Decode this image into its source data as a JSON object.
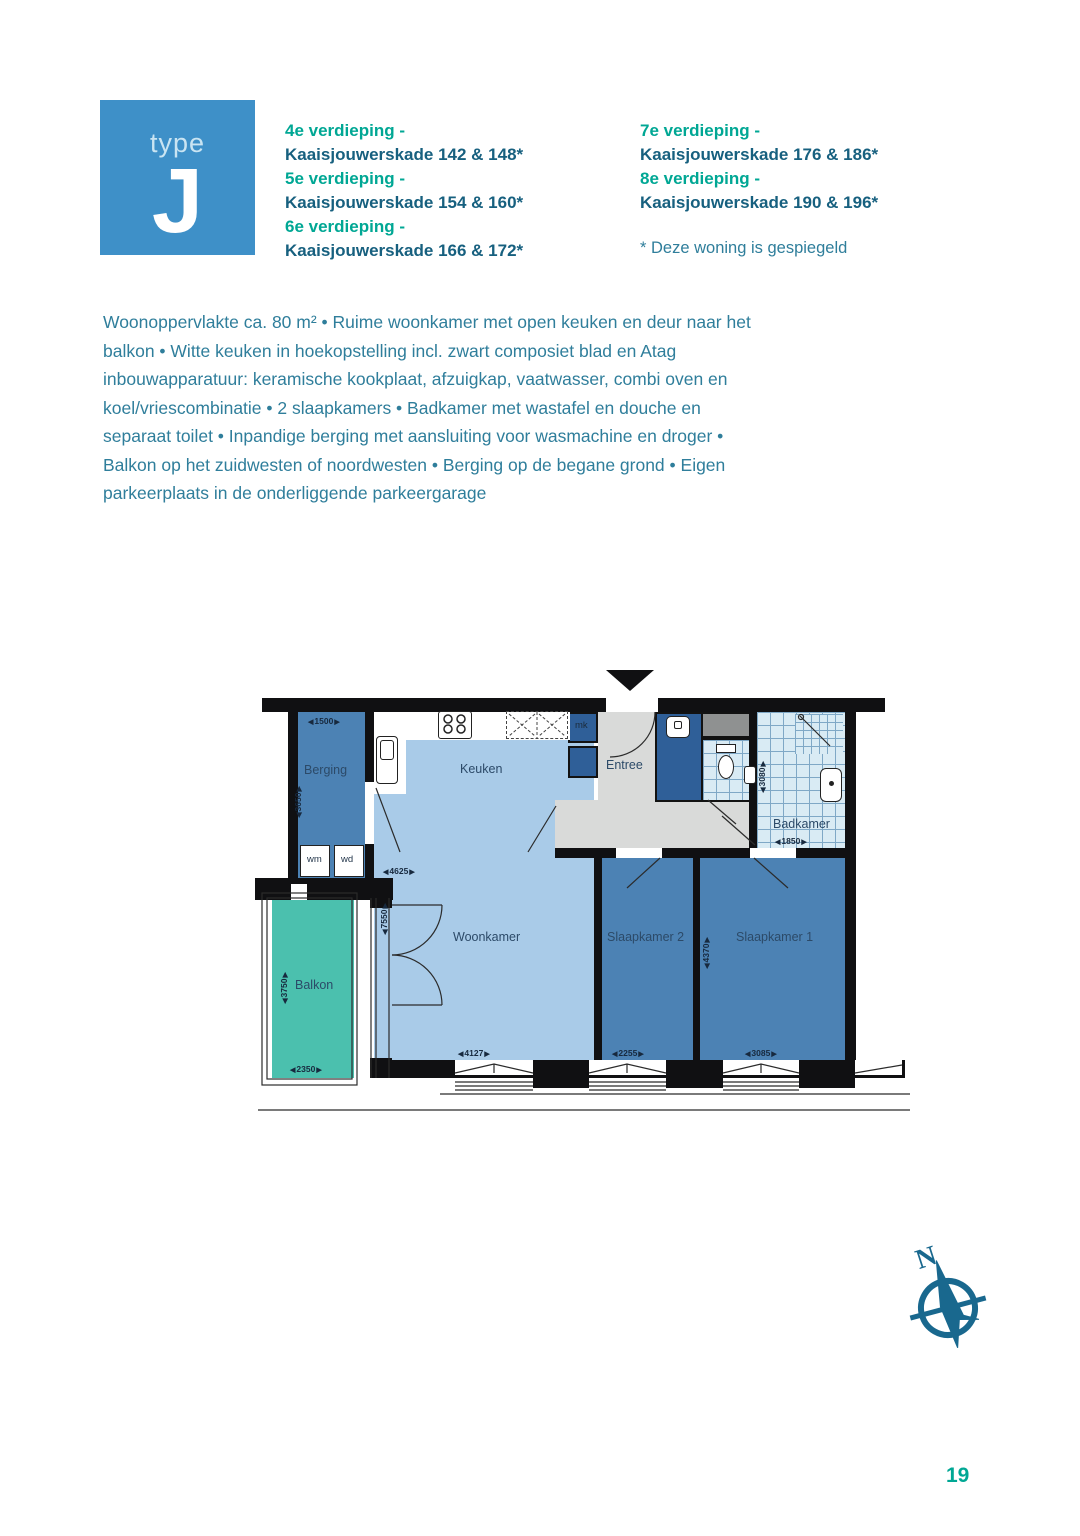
{
  "badge": {
    "word": "type",
    "letter": "J"
  },
  "floors": {
    "col1": [
      {
        "floor": "4e verdieping -",
        "address": "Kaaisjouwerskade 142 & 148*"
      },
      {
        "floor": "5e verdieping -",
        "address": "Kaaisjouwerskade 154 & 160*"
      },
      {
        "floor": "6e verdieping -",
        "address": "Kaaisjouwerskade 166 & 172*"
      }
    ],
    "col2": [
      {
        "floor": "7e verdieping -",
        "address": "Kaaisjouwerskade 176 & 186*"
      },
      {
        "floor": "8e verdieping -",
        "address": "Kaaisjouwerskade 190 & 196*"
      }
    ],
    "mirror_note": "* Deze woning is gespiegeld"
  },
  "description": "Woonoppervlakte ca. 80 m² • Ruime woonkamer met open keuken en deur naar het balkon • Witte keuken in hoekopstelling incl. zwart composiet blad en Atag inbouwapparatuur: keramische kookplaat, afzuigkap, vaatwasser, combi oven en koel/vriescombinatie • 2 slaapkamers • Badkamer met wastafel en douche en separaat toilet • Inpandige berging met aansluiting voor wasmachine en droger • Balkon op het zuidwesten of noordwesten • Berging op de begane grond • Eigen parkeerplaats in de onderliggende parkeergarage",
  "plan": {
    "rooms": {
      "berging": "Berging",
      "keuken": "Keuken",
      "entree": "Entree",
      "badkamer": "Badkamer",
      "woonkamer": "Woonkamer",
      "slaapkamer2": "Slaapkamer 2",
      "slaapkamer1": "Slaapkamer 1",
      "balkon": "Balkon",
      "mk": "mk",
      "wm": "wm",
      "wd": "wd"
    },
    "dimensions": {
      "berging_width": "1500",
      "berging_depth": "3650",
      "keuken_width": "4625",
      "woonkamer_depth": "7550",
      "woonkamer_width": "4127",
      "slaapkamer2_width": "2255",
      "slaapkamer1_width": "3085",
      "slaapkamer1_depth": "4370",
      "badkamer_depth": "3080",
      "badkamer_width": "1850",
      "balkon_depth": "3750",
      "balkon_width": "2350"
    }
  },
  "compass": {
    "north_label": "N"
  },
  "page_number": "19",
  "colors": {
    "accent_teal": "#00A794",
    "heading_blue": "#17607F",
    "body_text": "#2F7E9B",
    "badge_blue": "#3E90C8",
    "room_light_blue": "#A9CBE8",
    "room_medium_blue": "#4C82B4",
    "room_dark_blue": "#2F5F98",
    "balcony_teal": "#4BC0AE",
    "hall_grey": "#D9DAD9"
  }
}
